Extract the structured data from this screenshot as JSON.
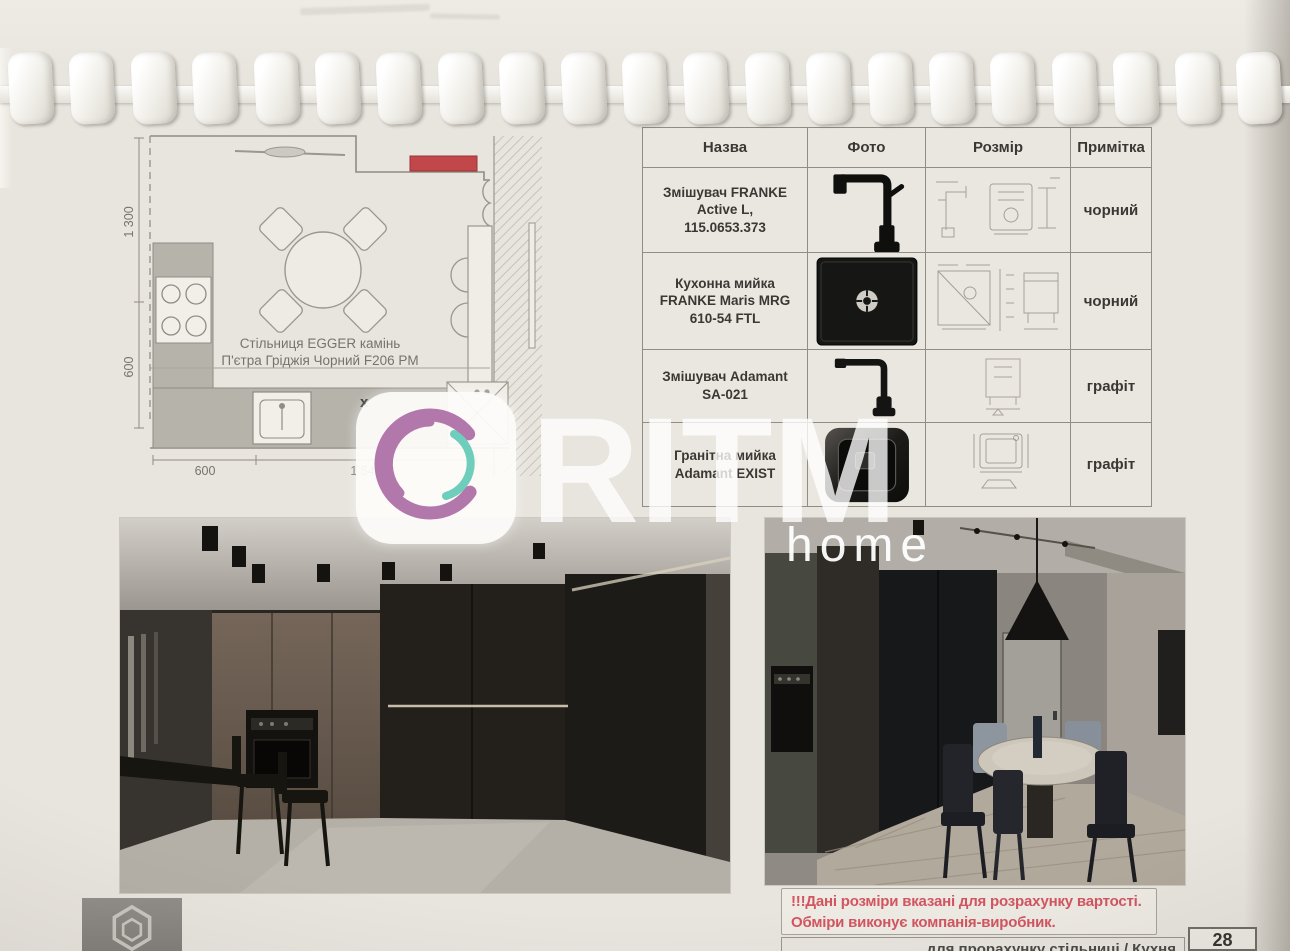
{
  "document": {
    "kind": "spiral-bound kitchen specification page",
    "paper_color": "#e8e5de"
  },
  "binding": {
    "comb_count": 21
  },
  "plan": {
    "label_line1": "Стільниця EGGER камінь",
    "label_line2": "П'єтра Гріджія Чорний F206 PM",
    "dims": {
      "left_upper": "1 300",
      "left_lower": "600",
      "bottom_left": "600",
      "bottom_right": "1 540"
    },
    "x_mark": "x",
    "accent_color": "#c2474b"
  },
  "table": {
    "headers": [
      "Назва",
      "Фото",
      "Розмір",
      "Примітка"
    ],
    "rows": [
      {
        "name": "Змішувач FRANKE\nActive L,\n115.0653.373",
        "note": "чорний",
        "photo_icon": "black-faucet"
      },
      {
        "name": "Кухонна мийка\nFRANKE Maris MRG\n610-54 FTL",
        "note": "чорний",
        "photo_icon": "black-square-sink"
      },
      {
        "name": "Змішувач Adamant\nSA-021",
        "note": "графіт",
        "photo_icon": "black-faucet"
      },
      {
        "name": "Гранітна мийка\nAdamant EXIST",
        "note": "графіт",
        "photo_icon": "dark-granite-sink"
      }
    ]
  },
  "watermark": {
    "brand": "RITM",
    "sub": "home",
    "ring_color": "#b277ab",
    "arc_color": "#6fcdbb"
  },
  "note": {
    "line1": "!!!Дані розміри вказані для розрахунку вартості.",
    "line2": "Обміри виконує компанія-виробник.",
    "color": "#d25560"
  },
  "footer": {
    "title_fragment": "для прорахунку стільниці / Кухня",
    "page_number": "28"
  }
}
